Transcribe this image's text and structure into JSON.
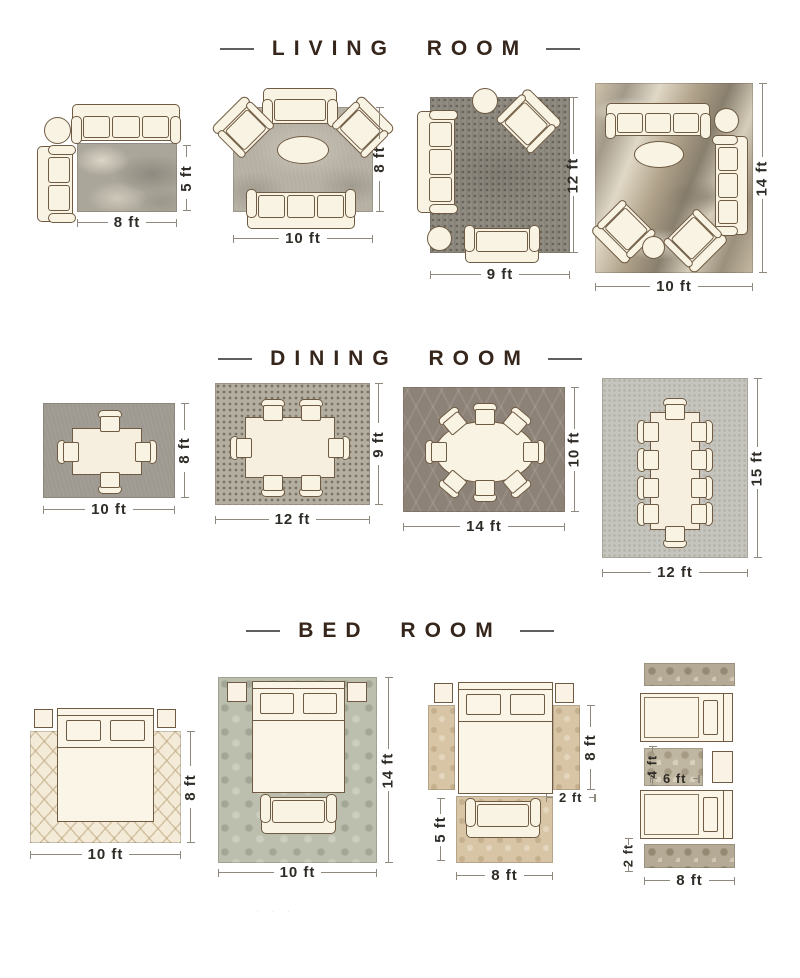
{
  "watermark": "· · · ·",
  "colors": {
    "background": "#ffffff",
    "title_text": "#35251a",
    "title_dash": "#5f5f5f",
    "furniture_fill": "#f9f3e4",
    "furniture_outline": "#6f5b43",
    "dimension_line": "#8f897d",
    "dimension_text": "#2f2c27"
  },
  "sections": [
    {
      "title": "LIVING ROOM",
      "layouts": [
        {
          "rug": "mottled-gray-rug",
          "bottom": "8 ft",
          "side": "5 ft"
        },
        {
          "rug": "light-mottled-rug",
          "bottom": "10 ft",
          "side": "8 ft"
        },
        {
          "rug": "dark-textured-rug",
          "bottom": "9 ft",
          "side": "12 ft"
        },
        {
          "rug": "abstract-tan-gray-rug",
          "bottom": "10 ft",
          "side": "14 ft"
        }
      ]
    },
    {
      "title": "DINING ROOM",
      "layouts": [
        {
          "rug": "gray-rug",
          "bottom": "10 ft",
          "side": "8 ft"
        },
        {
          "rug": "mosaic-dot-rug",
          "bottom": "12 ft",
          "side": "9 ft"
        },
        {
          "rug": "trellis-gray-rug",
          "bottom": "14 ft",
          "side": "10 ft"
        },
        {
          "rug": "speckled-light-rug",
          "bottom": "12 ft",
          "side": "15 ft"
        }
      ]
    },
    {
      "title": "BED ROOM",
      "layouts": [
        {
          "rug": "cream-diamond-rug",
          "bottom": "10 ft",
          "side": "8 ft"
        },
        {
          "rug": "sage-damask-rug",
          "bottom": "10 ft",
          "side": "14 ft"
        },
        {
          "rug": "tan-floral-rugs",
          "bottom": "8 ft",
          "runner_side": "8 ft",
          "runner_width": "2 ft",
          "foot_side": "5 ft"
        },
        {
          "rug": "ornate-taupe-rugs",
          "bottom": "8 ft",
          "mid_width": "6 ft",
          "mid_height": "4 ft",
          "runner_width": "2 ft"
        }
      ]
    }
  ]
}
